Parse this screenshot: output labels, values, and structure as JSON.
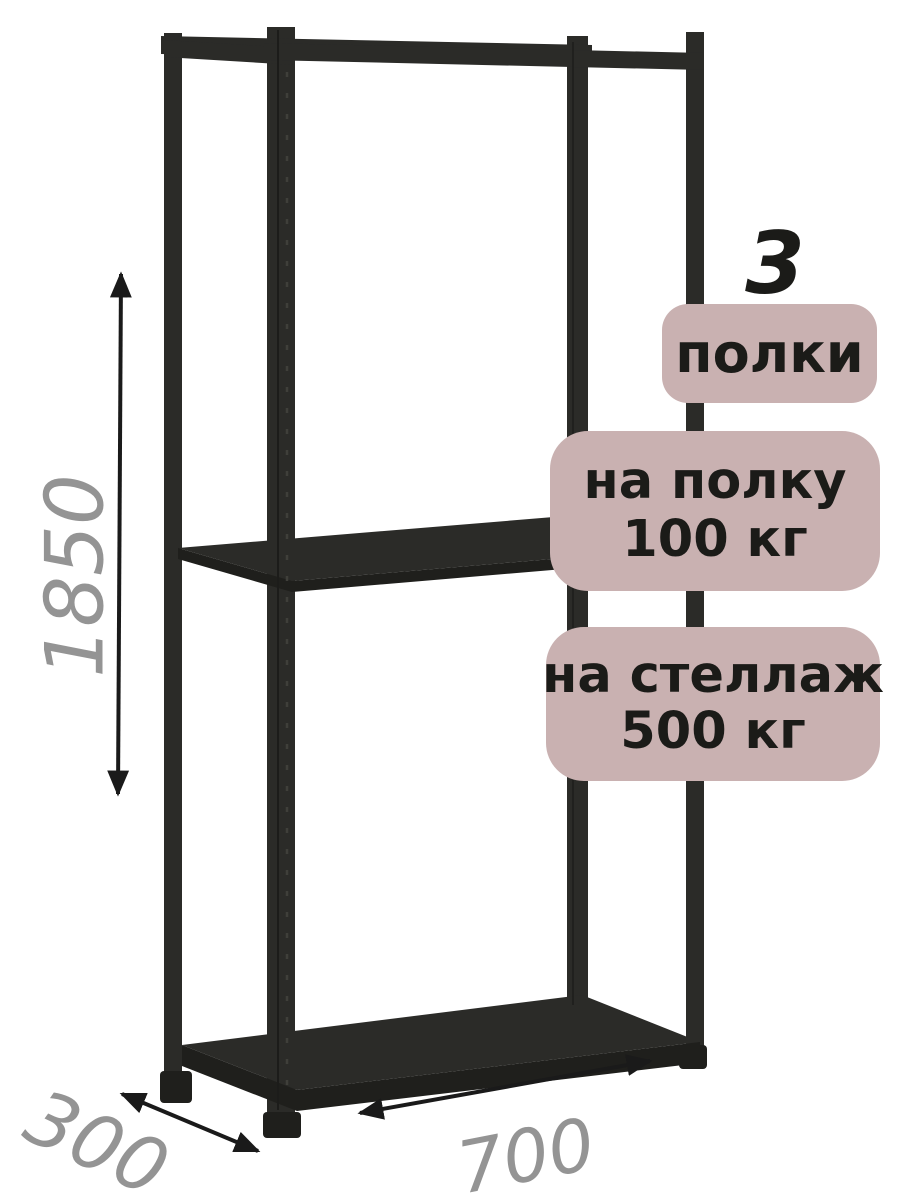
{
  "product_badges": {
    "shelf_count": {
      "number": "3",
      "label": "полки"
    },
    "per_shelf_load": {
      "line1": "на полку",
      "line2": "100 кг"
    },
    "per_rack_load": {
      "line1": "на стеллаж",
      "line2": "500 кг"
    }
  },
  "dimensions": {
    "height": "1850",
    "depth": "300",
    "width": "700"
  },
  "colors": {
    "background": "#ffffff",
    "rack_body": "#2b2b28",
    "rack_dark": "#1f1f1c",
    "rack_highlight": "#3f3f3a",
    "badge_background": "#c9b1b1",
    "badge_text": "#1b1b18",
    "dimension_text": "#949494",
    "arrow": "#1a1a1a"
  },
  "icons": {
    "height_arrow": "double-arrow-vertical",
    "depth_arrow": "double-arrow-diagonal",
    "width_arrow": "double-arrow-diagonal"
  }
}
